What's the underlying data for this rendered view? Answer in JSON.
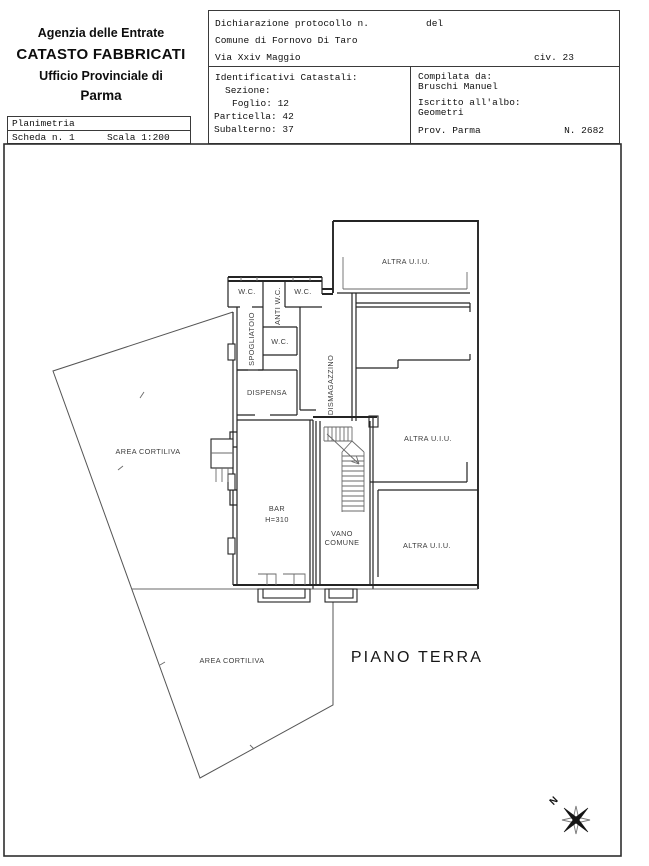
{
  "header": {
    "agency": {
      "line1": "Agenzia delle Entrate",
      "line2": "CATASTO FABBRICATI",
      "line3": "Ufficio Provinciale di",
      "line4": "Parma"
    },
    "planimetria": {
      "title": "Planimetria",
      "scheda": "Scheda n. 1",
      "scala": "Scala 1:200"
    },
    "declaration": {
      "protocollo": "Dichiarazione protocollo n.",
      "del": "del",
      "comune": "Comune di Fornovo Di Taro",
      "via": "Via Xxiv Maggio",
      "civ": "civ. 23"
    },
    "catastali": {
      "title": "Identificativi Catastali:",
      "sezione": "Sezione:",
      "foglio": "Foglio: 12",
      "particella": "Particella: 42",
      "subalterno": "Subalterno: 37"
    },
    "compilata": {
      "da_label": "Compilata da:",
      "da_value": "Bruschi Manuel",
      "albo_label": "Iscritto all'albo:",
      "albo_value": "Geometri",
      "prov": "Prov. Parma",
      "numero": "N. 2682"
    }
  },
  "plan": {
    "floor_title": "PIANO TERRA",
    "north": "N",
    "labels": {
      "wc_top_left": "W.C.",
      "wc_top_right": "W.C.",
      "anti_wc": "ANTI W.C.",
      "spogliatoio": "SPOGLIATOIO",
      "wc_mid": "W.C.",
      "dispensa": "DISPENSA",
      "dismagazzino": "DISMAGAZZINO",
      "altra_uiu_top": "ALTRA U.I.U.",
      "altra_uiu_mid": "ALTRA U.I.U.",
      "altra_uiu_bottom": "ALTRA U.I.U.",
      "bar": "BAR",
      "bar_height": "H=310",
      "vano_line1": "VANO",
      "vano_line2": "COMUNE",
      "area_cortiliva_left": "AREA CORTILIVA",
      "area_cortiliva_bottom": "AREA CORTILIVA"
    }
  }
}
